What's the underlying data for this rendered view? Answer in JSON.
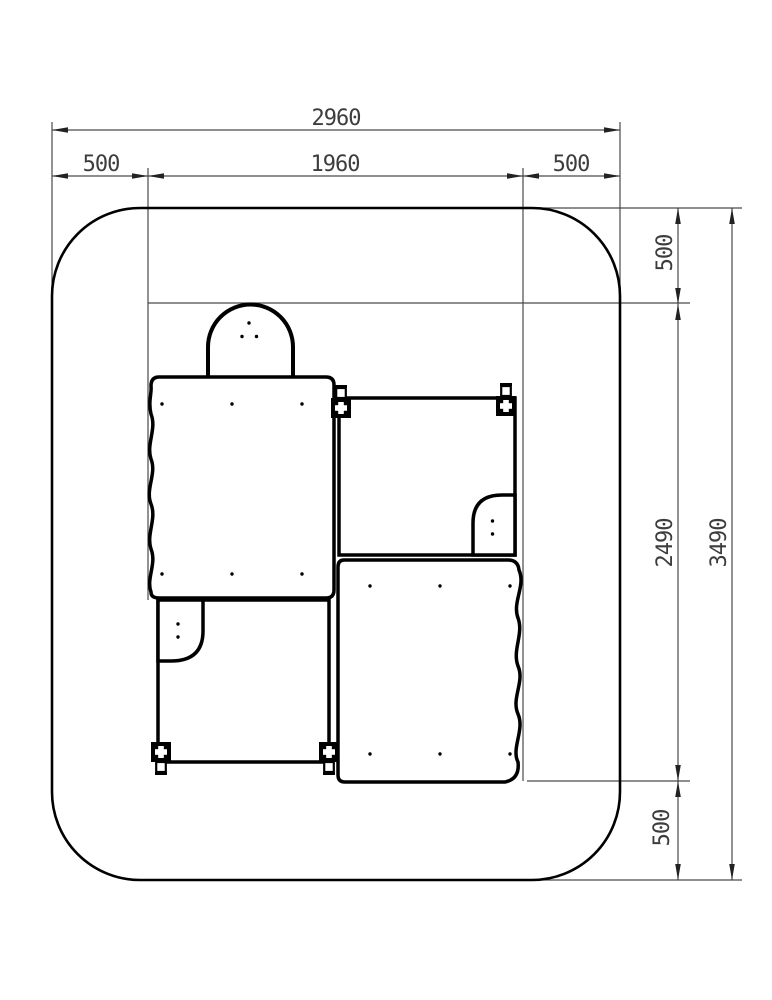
{
  "dims": {
    "top_total": "2960",
    "top_left": "500",
    "top_span": "1960",
    "top_right": "500",
    "right_top": "500",
    "right_span": "2490",
    "right_bottom": "500",
    "right_total": "3490"
  },
  "colors": {
    "outline": "#000000",
    "dimension_line": "#4a4a4a",
    "label_text": "#3d3d3d",
    "background": "#ffffff"
  }
}
